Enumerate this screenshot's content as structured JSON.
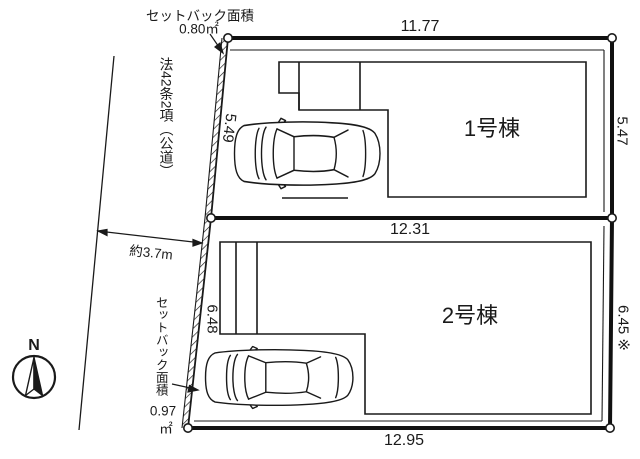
{
  "colors": {
    "ink": "#1a1a1a",
    "background": "#ffffff"
  },
  "annotations": {
    "setback_top": {
      "line1": "セットバック面積",
      "line2": "0.80㎡"
    },
    "road_law": "法42条2項（公道）",
    "road_width": "約3.7m",
    "setback_bottom": {
      "label": "セットバック面積",
      "value": "0.97",
      "unit": "㎡"
    },
    "compass": "N"
  },
  "lots": {
    "lot1": {
      "name": "1号棟",
      "dim_top": "11.77",
      "dim_right": "5.47",
      "dim_left": "5.49"
    },
    "lot2": {
      "name": "2号棟",
      "dim_top": "12.31",
      "dim_right": "6.45 ※",
      "dim_left": "6.48",
      "dim_bottom": "12.95"
    }
  }
}
